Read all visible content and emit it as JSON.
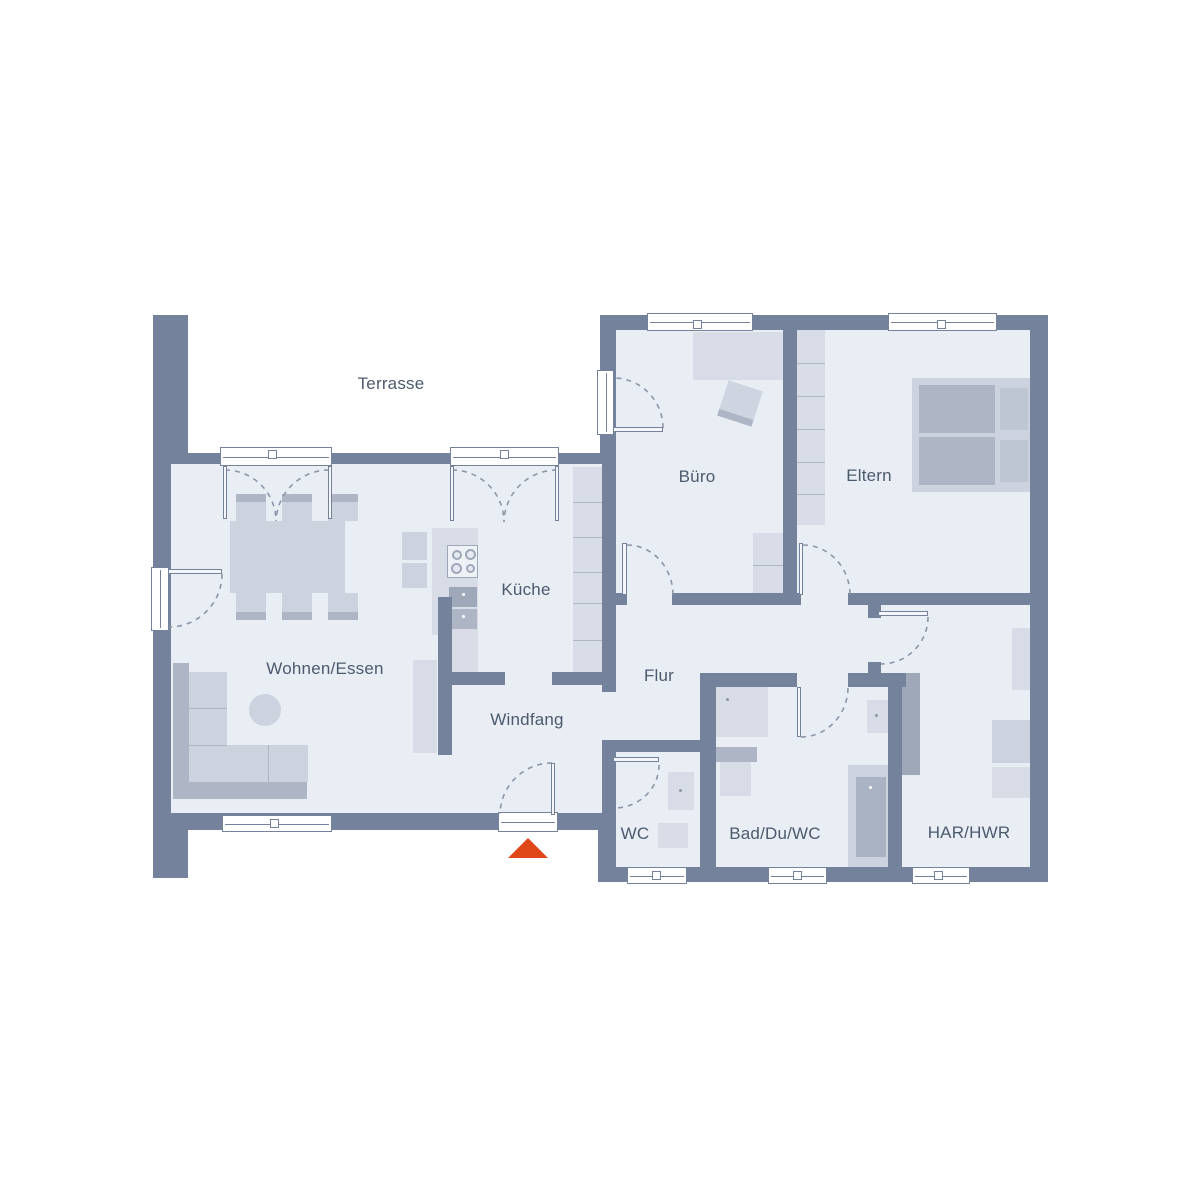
{
  "plan": {
    "type": "floorplan",
    "style": "architectural top view, ground floor"
  },
  "rooms": {
    "terrasse": {
      "label": "Terrasse"
    },
    "wohnen_essen": {
      "label": "Wohnen/Essen"
    },
    "kueche": {
      "label": "Küche"
    },
    "windfang": {
      "label": "Windfang"
    },
    "flur": {
      "label": "Flur"
    },
    "buero": {
      "label": "Büro"
    },
    "eltern": {
      "label": "Eltern"
    },
    "wc": {
      "label": "WC"
    },
    "bad": {
      "label": "Bad/Du/WC"
    },
    "har_hwr": {
      "label": "HAR/HWR"
    }
  },
  "markers": {
    "entrance": {
      "symbol": "triangle-up",
      "color": "#e0481a"
    }
  },
  "colors": {
    "wall": "#75829b",
    "floor": "#e9edf4",
    "bg": "#ffffff",
    "furn-light": "#d7dce6",
    "furn-mid": "#ccd3df",
    "furn-dark": "#aeb6c5",
    "appliance": "#9ea8b8",
    "arc": "#8d96a7",
    "accent": "#e0481a",
    "text": "#4d5a6e"
  }
}
